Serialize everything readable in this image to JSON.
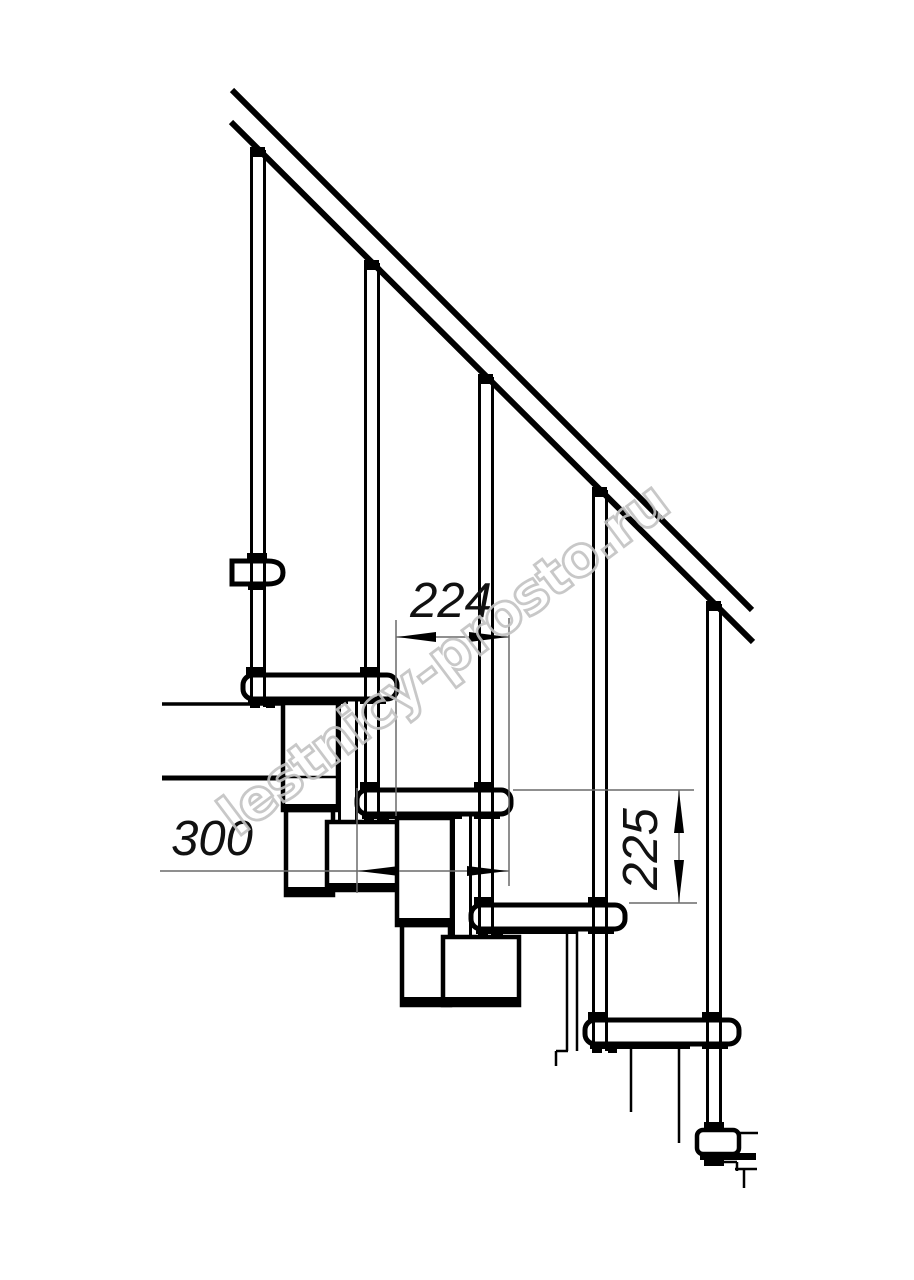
{
  "drawing": {
    "watermark_text": "lestnicy-prosto.ru",
    "dimensions": {
      "step_run": "224",
      "tread_depth": "300",
      "step_rise": "225"
    },
    "colors": {
      "line": "#000000",
      "dimension_line": "#6a6a6a",
      "dimension_text": "#111111",
      "watermark": "#c3c3c3",
      "background": "#ffffff"
    }
  }
}
